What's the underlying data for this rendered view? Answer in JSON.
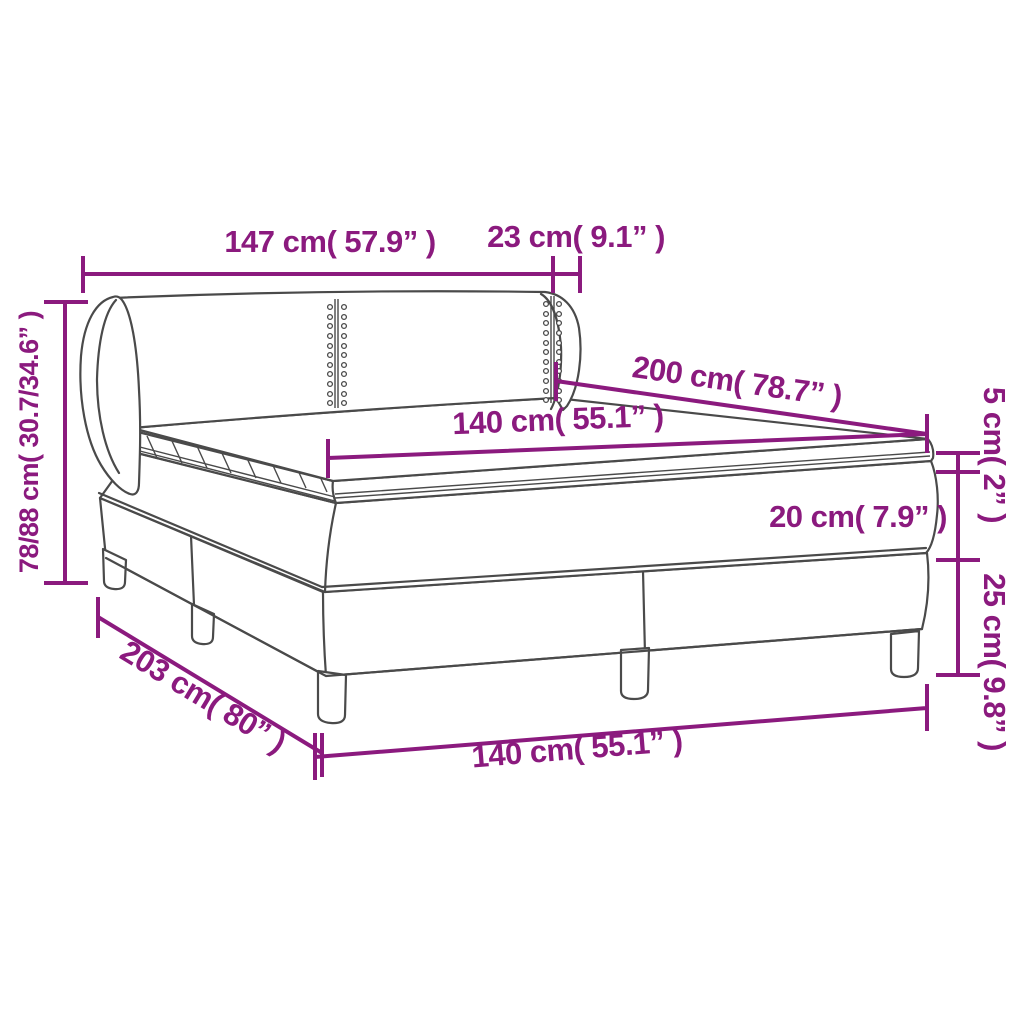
{
  "diagram": {
    "description": "Box spring bed with headboard, mattress and topper — dimension drawing",
    "accent_color": "#8B1A7E",
    "line_art_color": "#4A4A4A",
    "background_color": "#FFFFFF",
    "labels": {
      "headboard_width": "147 cm( 57.9” )",
      "headboard_side_depth": "23 cm( 9.1” )",
      "headboard_height": "78/88 cm( 30.7/34.6” )",
      "mattress_length": "200 cm( 78.7” )",
      "mattress_width": "140 cm( 55.1” )",
      "topper_thickness": "5 cm( 2” )",
      "mattress_thickness": "20 cm( 7.9” )",
      "base_height": "25 cm( 9.8” )",
      "total_length": "203 cm( 80” )",
      "base_width": "140 cm( 55.1” )"
    }
  }
}
